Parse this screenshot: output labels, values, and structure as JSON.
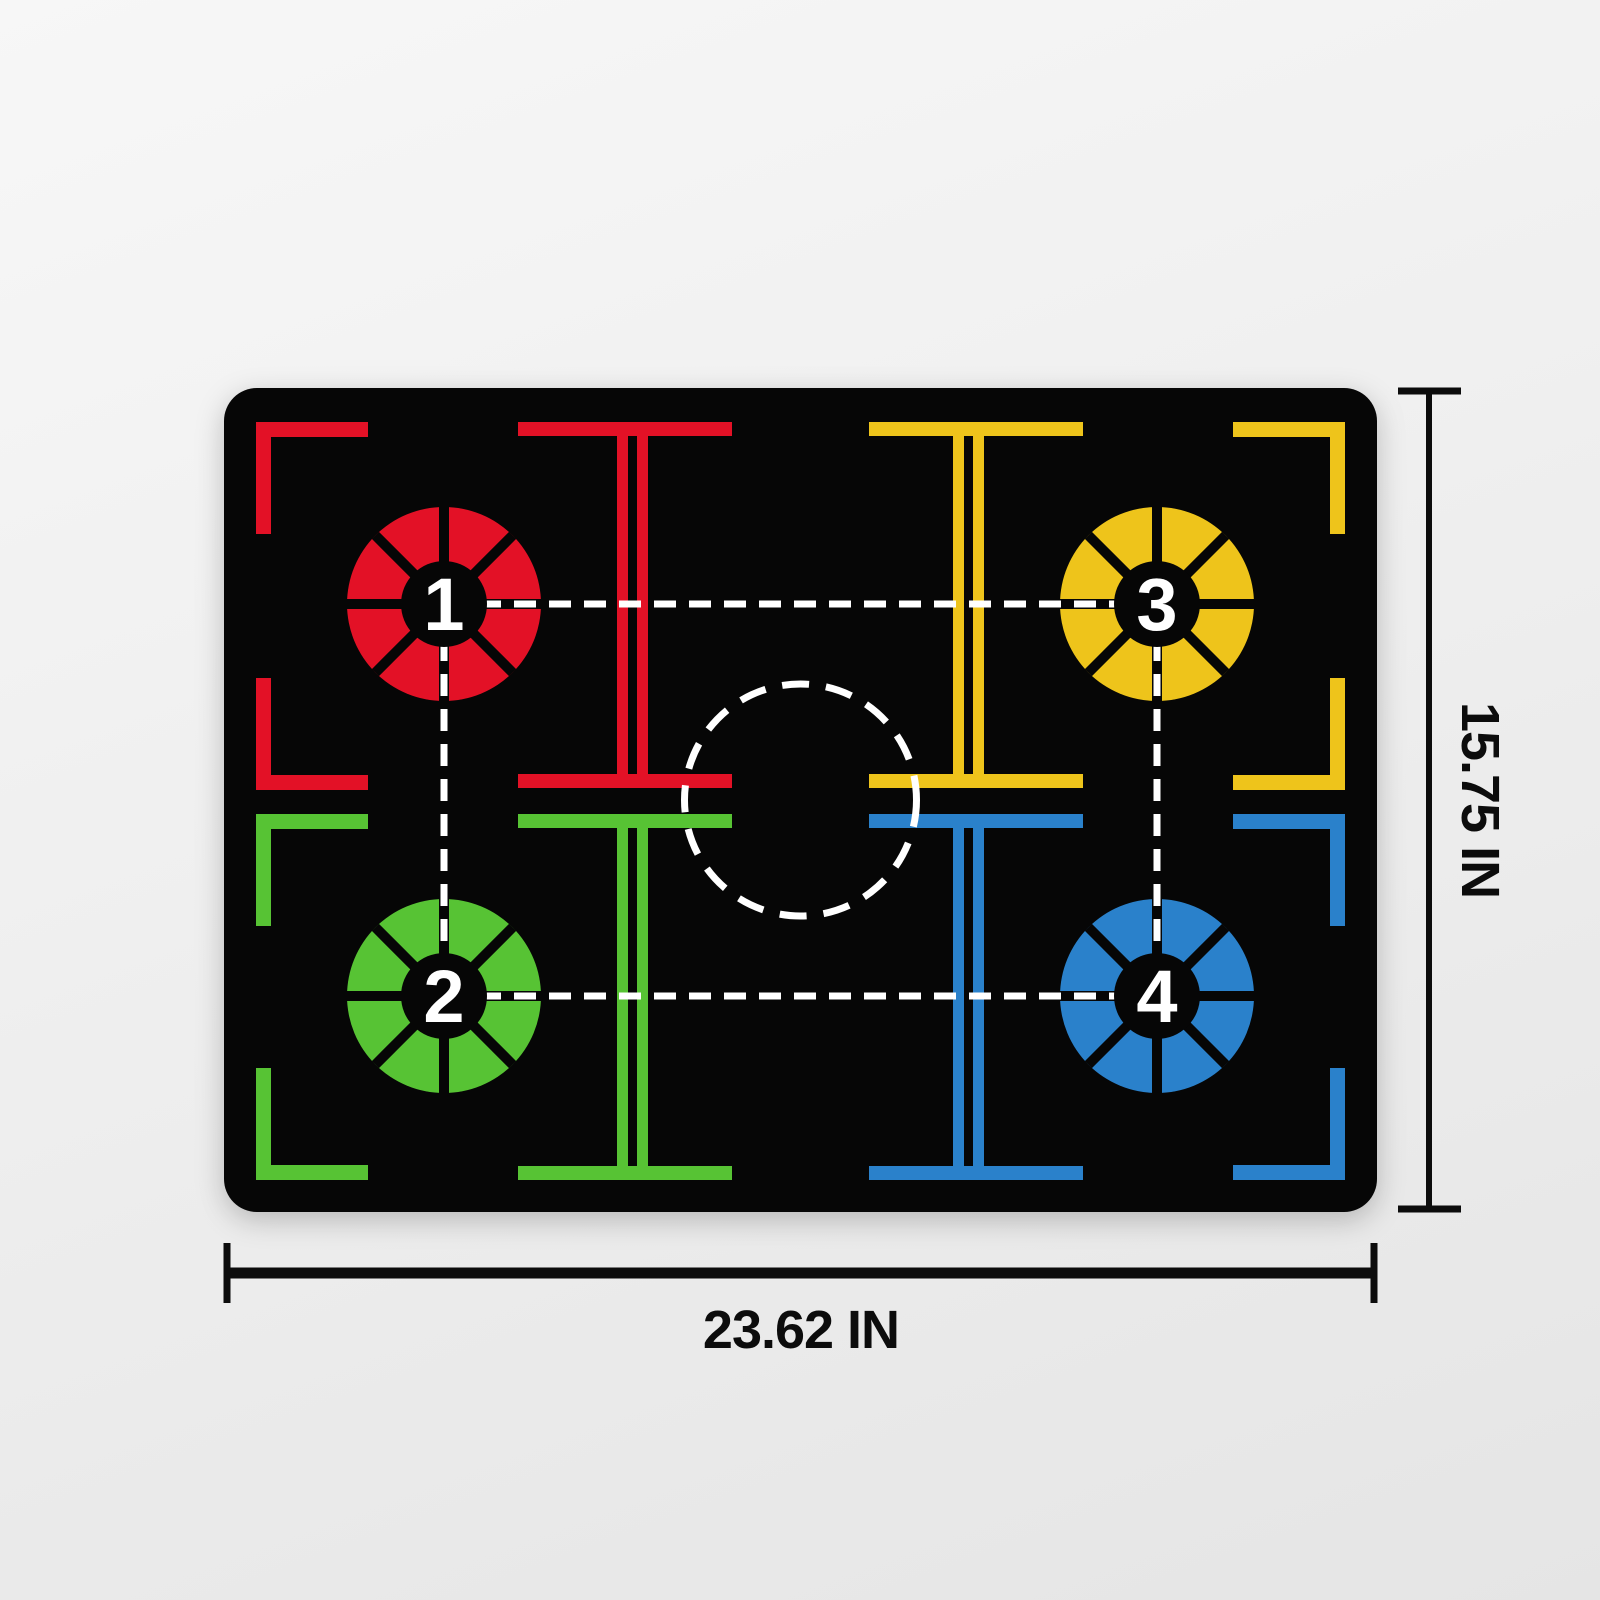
{
  "diagram": {
    "mat_color": "#060606",
    "guide_color": "#ffffff",
    "dimension_color": "#0c0c0c"
  },
  "spots": [
    {
      "label": "1",
      "color": "#e31126",
      "position": "top-left"
    },
    {
      "label": "2",
      "color": "#57c334",
      "position": "bottom-left"
    },
    {
      "label": "3",
      "color": "#eec41b",
      "position": "top-right"
    },
    {
      "label": "4",
      "color": "#2a81cb",
      "position": "bottom-right"
    }
  ],
  "dimensions": {
    "width_label": "23.62 IN",
    "height_label": "15.75 IN"
  }
}
